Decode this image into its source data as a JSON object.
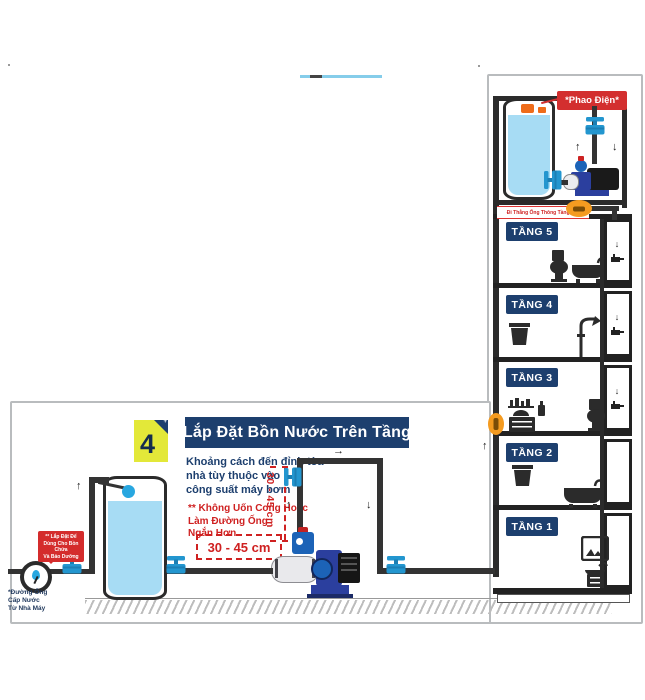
{
  "colors": {
    "navy": "#1d3f6e",
    "red": "#d32f2f",
    "yellow": "#e3e839",
    "pipe": "#333333",
    "water": "#a7dcf4",
    "valve_blue": "#2396cf",
    "valve_orange": "#f49b20",
    "border_gray": "#b9bcbe"
  },
  "icons": {
    "arrow_up": "↑",
    "arrow_down": "↓",
    "arrow_right": "→",
    "sparkle": "+"
  },
  "roof": {
    "float_label": "*Phao Điện*",
    "pipe_note": "Đi Thẳng Ống Thông Tầng Mái"
  },
  "floors": [
    {
      "label": "TẦNG 5",
      "fixtures": [
        "toilet",
        "bathtub"
      ],
      "shaft_valve": true
    },
    {
      "label": "TẦNG 4",
      "fixtures": [
        "laundry-basket",
        "shower"
      ],
      "shaft_valve": true
    },
    {
      "label": "TẦNG 3",
      "fixtures": [
        "vanity-shelf",
        "soap-bottle",
        "toilet"
      ],
      "shaft_valve": true
    },
    {
      "label": "TẦNG 2",
      "fixtures": [
        "laundry-basket",
        "bathtub"
      ],
      "shaft_valve": false
    },
    {
      "label": "TẦNG 1",
      "fixtures": [
        "mirror",
        "sink-vanity"
      ],
      "shaft_valve": false
    }
  ],
  "panel": {
    "step_number": "4",
    "title": "Lắp Đặt Bồn Nước Trên Tầng",
    "subtitle_line1": "Khoảng cách đến đỉnh tòa",
    "subtitle_line2": "nhà tùy thuộc vào",
    "subtitle_line3": "công suất máy bơm",
    "warning_line1": "** Không Uốn Cong Hoặc",
    "warning_line2": "Làm Đường Ống",
    "warning_line3": "Ngắn Hơn",
    "distance_box": "30 - 45 cm",
    "distance_vertical": "30 - 45 cm",
    "bubble_line1": "** Lắp Đặt Để",
    "bubble_line2": "Dùng Cho Bồn Chứa",
    "bubble_line3": "Và Bảo Dưỡng",
    "meter_line1": "*Đường Ống",
    "meter_line2": "Cấp Nước",
    "meter_line3": "Từ Nhà Máy"
  }
}
